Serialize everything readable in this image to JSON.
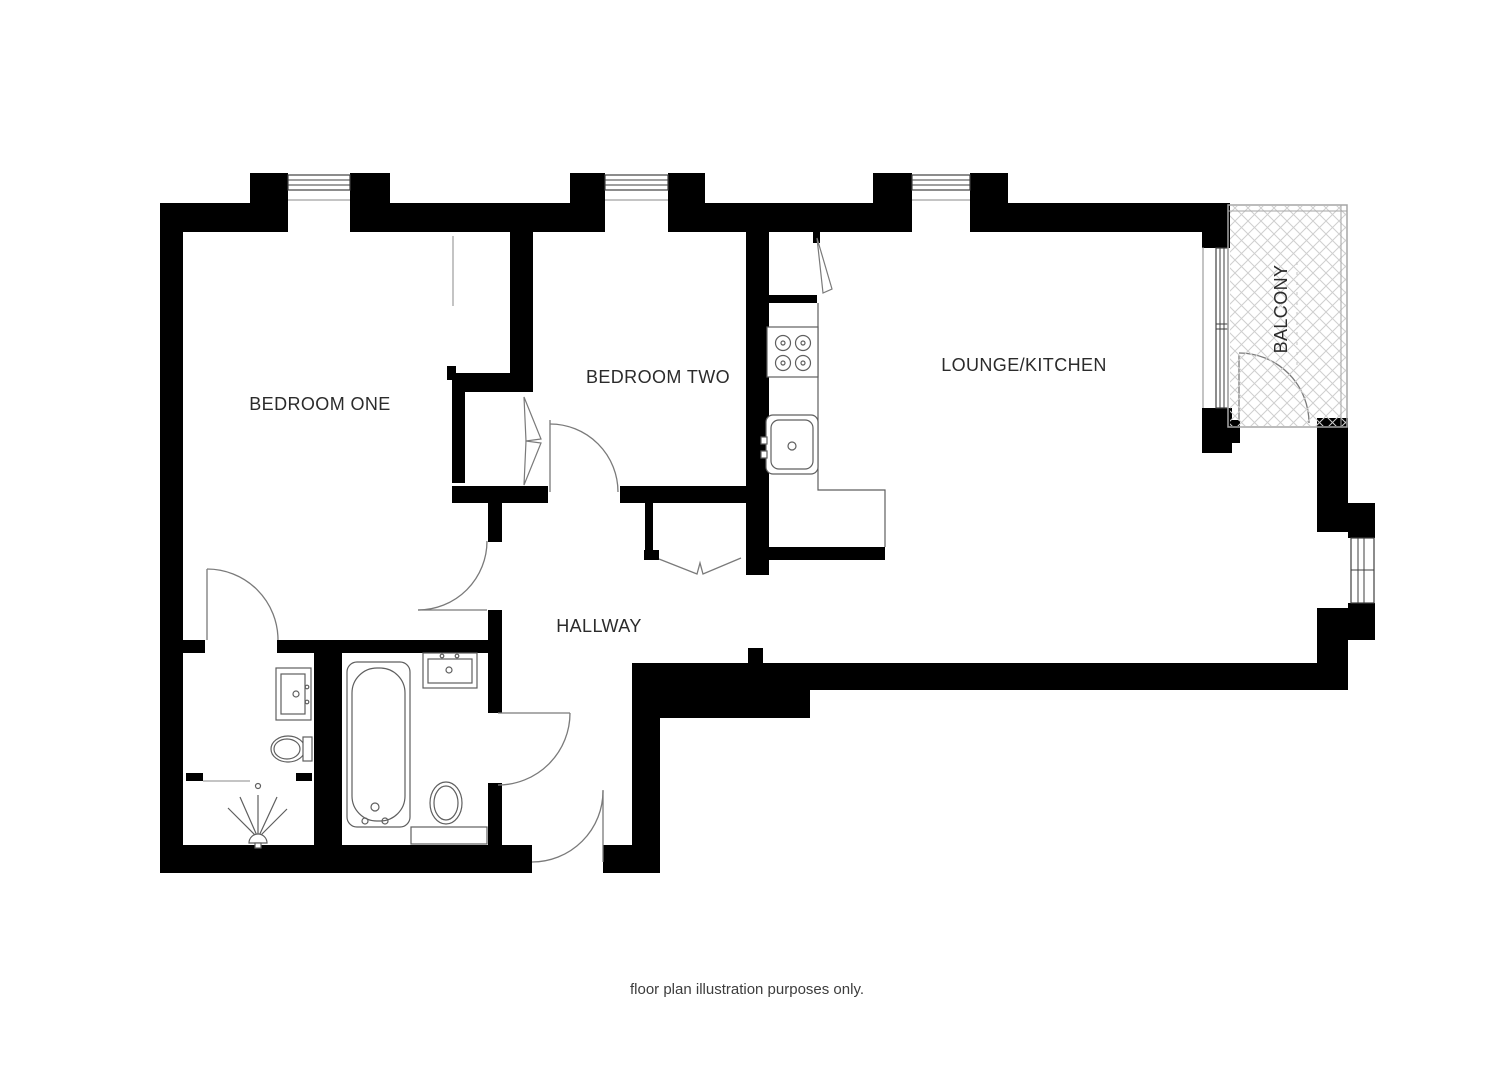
{
  "labels": {
    "bedroom_one": "BEDROOM ONE",
    "bedroom_two": "BEDROOM TWO",
    "lounge_kitchen": "LOUNGE/KITCHEN",
    "hallway": "HALLWAY",
    "balcony": "BALCONY"
  },
  "caption": "floor plan illustration purposes only.",
  "colors": {
    "wall": "#000000",
    "fixture-line": "#5f5f5f",
    "door-line": "#7a7a7a",
    "window-line": "#3f3f3f",
    "hatch-line": "#cfcfcf",
    "balcony-border": "#a5a5a5",
    "label-text": "#2b2b2b",
    "caption-text": "#3d3d3d",
    "background": "#ffffff"
  },
  "fixtures": {
    "kitchen": [
      "hob",
      "kitchen-sink",
      "worktop",
      "utility-cupboard"
    ],
    "bathroom": [
      "bathtub",
      "vanity-sink",
      "toilet"
    ],
    "ensuite": [
      "vanity-sink",
      "toilet",
      "shower"
    ],
    "storage": [
      "hallway-cupboard",
      "bedroom-two-wardrobe"
    ]
  }
}
